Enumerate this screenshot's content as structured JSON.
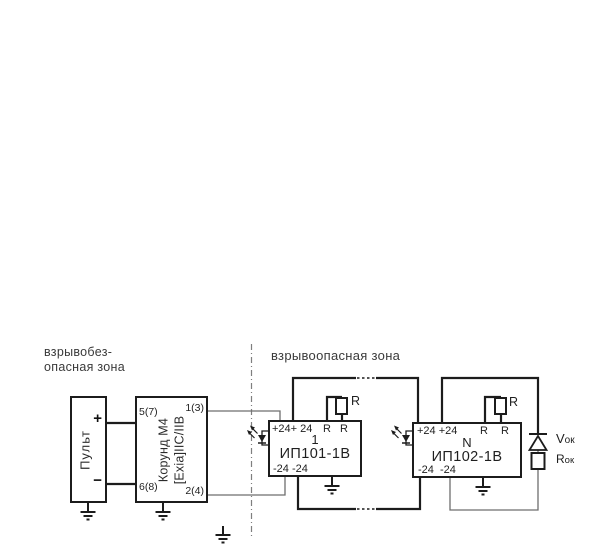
{
  "zones": {
    "safe_line1": "взрывобез-",
    "safe_line2": "опасная зона",
    "hazard": "взрывоопасная зона"
  },
  "pult": {
    "name": "Пульт",
    "plus": "+",
    "minus": "−"
  },
  "barrier": {
    "name_line1": "Корунд М4",
    "name_line2": "[Exia]IIC/IIB",
    "t_top_left": "5(7)",
    "t_bottom_left": "6(8)",
    "t_top_right": "1(3)",
    "t_bottom_right": "2(4)"
  },
  "module1": {
    "number": "1",
    "model": "ИП101-1В",
    "top_terminals": "+24+ 24",
    "r1": "R",
    "r2": "R",
    "shunt_label": "R",
    "bottom_terminals": "-24 -24"
  },
  "moduleN": {
    "number": "N",
    "model": "ИП102-1В",
    "top_terminals": "+24 +24",
    "r1": "R",
    "r2": "R",
    "shunt_label": "R",
    "bottom_terminals": "-24  -24"
  },
  "terminator": {
    "v_main": "V",
    "v_sub": "ок",
    "r_main": "R",
    "r_sub": "ок"
  }
}
